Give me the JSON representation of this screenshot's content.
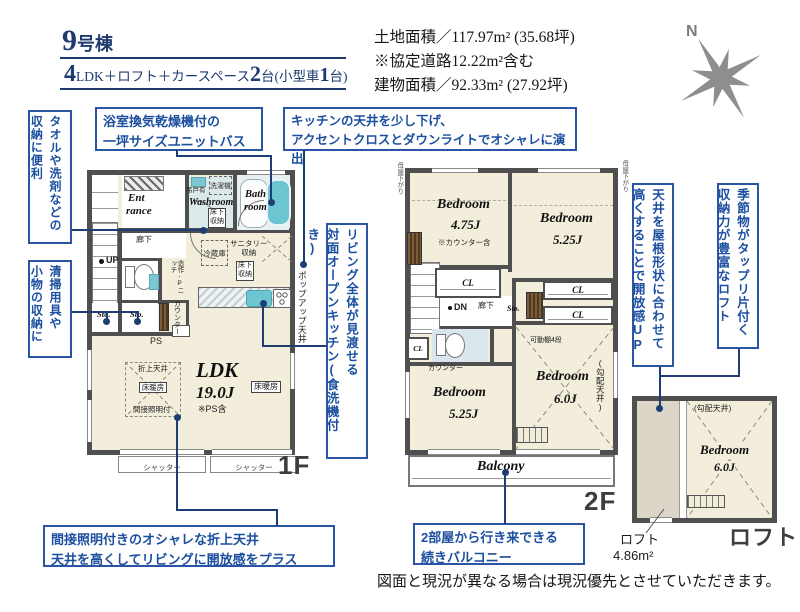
{
  "colors": {
    "annotation_blue": "#2a55a5",
    "navy_title": "#1e3a6e",
    "wall_gray": "#4f4f4f",
    "floor_cream": "#f3eedb",
    "bath_teal": "#6cc6d1",
    "loft_gray": "#dcd6c9"
  },
  "header": {
    "building_num": "9",
    "building_suffix": "号棟",
    "layout_parts": {
      "n1": "4",
      "t1": "LDK＋ロフト＋カースペース",
      "n2": "2",
      "t2": "台(小型車",
      "n3": "1",
      "t3": "台)"
    },
    "land_area": "土地面積／117.97m² (35.68坪)",
    "road_note": "※協定道路12.22m²含む",
    "building_area": "建物面積／92.33m² (27.92坪)",
    "compass_n": "N"
  },
  "notes": {
    "towel": {
      "l1": "タオルや洗剤などの",
      "l2": "収納に便利"
    },
    "cleaning": {
      "l1": "清掃用具や",
      "l2": "小物の収納に"
    },
    "bath": {
      "l1": "浴室換気乾燥機付の",
      "l2": "一坪サイズユニットバス"
    },
    "kitchen": {
      "l1": "キッチンの天井を少し下げ、",
      "l2": "アクセントクロスとダウンライトでオシャレに演出"
    },
    "open_kitchen": {
      "l1": "リビング全体が見渡せる",
      "l2": "対面オープンキッチン(食洗機付き)"
    },
    "roof": {
      "l1": "天井を屋根形状に合わせて",
      "l2": "高くすることで開放感UP"
    },
    "loft": {
      "l1": "季節物がタップリ片付く",
      "l2": "収納力が豊富なロフト"
    },
    "coffered": {
      "l1": "間接照明付きのオシャレな折上天井",
      "l2": "天井を高くしてリビングに開放感をプラス"
    },
    "balcony": {
      "l1": "2部屋から行き来できる",
      "l2": "続きバルコニー"
    }
  },
  "f1": {
    "entrance1": "Ent",
    "entrance2": "rance",
    "hallway": "廊下",
    "up": "UP",
    "washroom": "Washroom",
    "hanging": "吊戸有",
    "washer": "洗濯機",
    "underfloor1": "床下収納",
    "bath1": "Bath",
    "bath2": "room",
    "fridge": "冷蔵庫",
    "sanitary1": "サニタリー",
    "sanitary2": "収納",
    "underfloor2": "床下収納",
    "sto1": "Sto.",
    "sto2": "Sto.",
    "ps": "PS",
    "niche": "造作-Pニッチ",
    "counter": "カウンター",
    "popup": "ポップアップ天井",
    "ldk": "LDK",
    "ldk_size": "19.0J",
    "ps_note": "※PS含",
    "heating1": "床暖房",
    "heating2": "床暖房",
    "coffered": "折上天井",
    "indirect": "間接照明付",
    "shutter1": "シャッター",
    "shutter2": "シャッター",
    "floor_label": "1F"
  },
  "f2": {
    "br1_name": "Bedroom",
    "br1_size": "4.75J",
    "br1_note": "※カウンター含",
    "br2_name": "Bedroom",
    "br2_size": "5.25J",
    "br3_name": "Bedroom",
    "br3_size": "5.25J",
    "br4_name": "Bedroom",
    "br4_size": "6.0J",
    "br4_shelf": "可動棚4段",
    "br4_ceiling": "(勾配天井)",
    "cl1": "CL",
    "cl2": "CL",
    "cl3": "CL",
    "cl4": "CL",
    "sto": "Sto.",
    "dn": "DN",
    "hallway": "廊下",
    "counter": "カウンター",
    "moya_left": "母屋下がり",
    "moya_right": "母屋下がり",
    "balcony": "Balcony",
    "floor_label": "2F"
  },
  "loft": {
    "ceiling": "(勾配天井)",
    "br_name": "Bedroom",
    "br_size": "6.0J",
    "floor_label": "ロフト",
    "area1": "ロフト",
    "area2": "4.86m²"
  },
  "footer": {
    "disclaimer": "図面と現況が異なる場合は現況優先とさせていただきます。"
  }
}
